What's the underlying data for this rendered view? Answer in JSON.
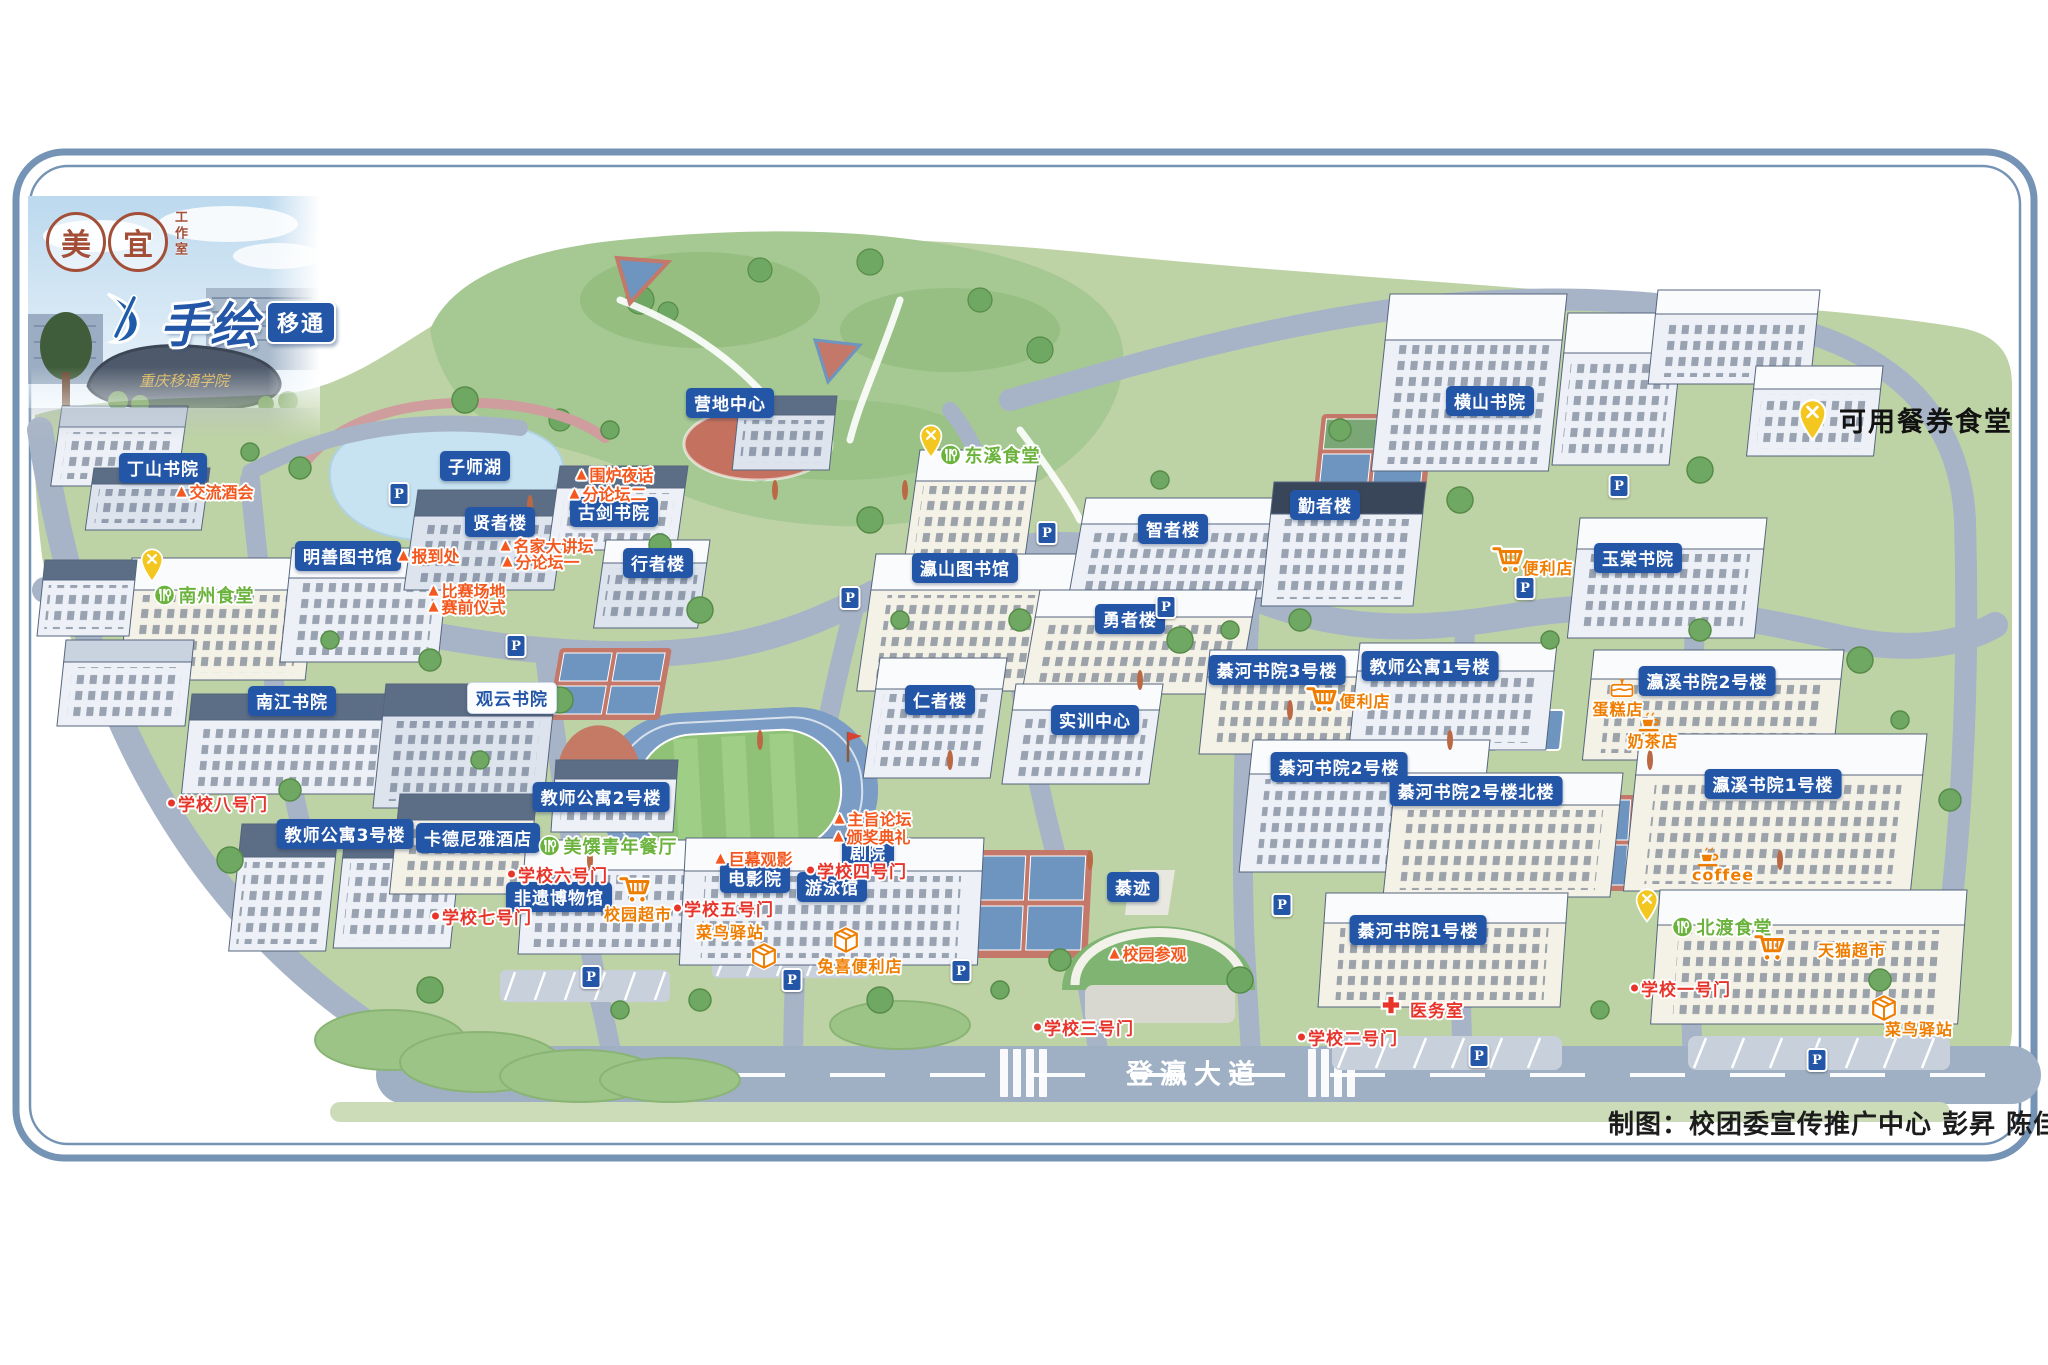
{
  "page": {
    "credits": "制图：校团委宣传推广中心  彭昇 陈佳妮"
  },
  "logo": {
    "seal_left": "美",
    "seal_right": "宜",
    "studio": "工作室",
    "title_main": "手绘",
    "title_sub": "移通",
    "photo_stone_text": "重庆移通学院"
  },
  "legend": {
    "dining_voucher": "可用餐券食堂"
  },
  "road": {
    "name": "登瀛大道"
  },
  "map": {
    "colors": {
      "label-blue": "#2456a8",
      "event-orange": "#f4581e",
      "gate-red": "#e8352b",
      "dining-green": "#6cb33e",
      "shop-orange": "#ef7d00",
      "voucher-yellow": "#f3c71f"
    },
    "parking_letter": "P",
    "blue_labels": [
      {
        "t": "丁山书院",
        "x": 163,
        "y": 468
      },
      {
        "t": "子师湖",
        "x": 475,
        "y": 466
      },
      {
        "t": "贤者楼",
        "x": 500,
        "y": 522
      },
      {
        "t": "古剑书院",
        "x": 614,
        "y": 512
      },
      {
        "t": "明善图书馆",
        "x": 348,
        "y": 556
      },
      {
        "t": "行者楼",
        "x": 658,
        "y": 563
      },
      {
        "t": "南江书院",
        "x": 292,
        "y": 701
      },
      {
        "t": "教师公寓3号楼",
        "x": 345,
        "y": 834
      },
      {
        "t": "卡德尼雅酒店",
        "x": 478,
        "y": 838
      },
      {
        "t": "教师公寓2号楼",
        "x": 601,
        "y": 797
      },
      {
        "t": "营地中心",
        "x": 730,
        "y": 403
      },
      {
        "t": "瀛山图书馆",
        "x": 965,
        "y": 568
      },
      {
        "t": "智者楼",
        "x": 1173,
        "y": 529
      },
      {
        "t": "勇者楼",
        "x": 1130,
        "y": 619
      },
      {
        "t": "仁者楼",
        "x": 940,
        "y": 700
      },
      {
        "t": "实训中心",
        "x": 1095,
        "y": 720
      },
      {
        "t": "勤者楼",
        "x": 1325,
        "y": 505
      },
      {
        "t": "横山书院",
        "x": 1490,
        "y": 401
      },
      {
        "t": "玉棠书院",
        "x": 1638,
        "y": 558
      },
      {
        "t": "綦河书院3号楼",
        "x": 1277,
        "y": 670
      },
      {
        "t": "教师公寓1号楼",
        "x": 1430,
        "y": 666
      },
      {
        "t": "綦河书院2号楼",
        "x": 1339,
        "y": 767
      },
      {
        "t": "綦河书院2号楼北楼",
        "x": 1476,
        "y": 791
      },
      {
        "t": "瀛溪书院2号楼",
        "x": 1707,
        "y": 681
      },
      {
        "t": "瀛溪书院1号楼",
        "x": 1773,
        "y": 784
      },
      {
        "t": "綦河书院1号楼",
        "x": 1418,
        "y": 930
      },
      {
        "t": "綦迹",
        "x": 1133,
        "y": 887
      },
      {
        "t": "剧院",
        "x": 868,
        "y": 852
      },
      {
        "t": "电影院",
        "x": 755,
        "y": 878
      },
      {
        "t": "游泳馆",
        "x": 832,
        "y": 887
      },
      {
        "t": "非遗博物馆",
        "x": 559,
        "y": 897
      }
    ],
    "white_labels": [
      {
        "t": "观云书院",
        "x": 512,
        "y": 698
      }
    ],
    "event_labels": [
      {
        "t": "交流酒会",
        "x": 215,
        "y": 491
      },
      {
        "t": "围炉夜话",
        "x": 615,
        "y": 474
      },
      {
        "t": "分论坛二",
        "x": 608,
        "y": 493
      },
      {
        "t": "报到处",
        "x": 429,
        "y": 555
      },
      {
        "t": "名家大讲坛",
        "x": 547,
        "y": 545
      },
      {
        "t": "分论坛一",
        "x": 541,
        "y": 561
      },
      {
        "t": "比赛场地",
        "x": 467,
        "y": 590
      },
      {
        "t": "赛前仪式",
        "x": 467,
        "y": 606
      },
      {
        "t": "主旨论坛",
        "x": 873,
        "y": 818
      },
      {
        "t": "颁奖典礼",
        "x": 872,
        "y": 836
      },
      {
        "t": "巨幕观影",
        "x": 754,
        "y": 858
      },
      {
        "t": "校园参观",
        "x": 1148,
        "y": 953
      }
    ],
    "gate_labels": [
      {
        "t": "学校八号门",
        "x": 218,
        "y": 803
      },
      {
        "t": "学校七号门",
        "x": 482,
        "y": 916
      },
      {
        "t": "学校六号门",
        "x": 558,
        "y": 874
      },
      {
        "t": "学校五号门",
        "x": 724,
        "y": 908
      },
      {
        "t": "学校四号门",
        "x": 857,
        "y": 870
      },
      {
        "t": "学校三号门",
        "x": 1084,
        "y": 1027
      },
      {
        "t": "学校二号门",
        "x": 1348,
        "y": 1037
      },
      {
        "t": "学校一号门",
        "x": 1681,
        "y": 988
      }
    ],
    "dining_labels": [
      {
        "t": "南州食堂",
        "x": 204,
        "y": 595,
        "pin": {
          "x": 152,
          "y": 565
        }
      },
      {
        "t": "东溪食堂",
        "x": 990,
        "y": 455,
        "pin": {
          "x": 931,
          "y": 441
        }
      },
      {
        "t": "北渡食堂",
        "x": 1722,
        "y": 927,
        "pin": {
          "x": 1647,
          "y": 905
        }
      },
      {
        "t": "美馔青年餐厅",
        "x": 608,
        "y": 846,
        "pin": null
      }
    ],
    "shop_labels": [
      {
        "t": "校园超市",
        "x": 638,
        "y": 913,
        "icon": "cart",
        "ix": 634,
        "iy": 889
      },
      {
        "t": "便利店",
        "x": 1548,
        "y": 567,
        "icon": "cart",
        "ix": 1507,
        "iy": 559
      },
      {
        "t": "便利店",
        "x": 1365,
        "y": 700,
        "icon": "cart",
        "ix": 1321,
        "iy": 699
      },
      {
        "t": "天猫超市",
        "x": 1852,
        "y": 949,
        "icon": "cart",
        "ix": 1769,
        "iy": 947
      },
      {
        "t": "兔喜便利店",
        "x": 860,
        "y": 965,
        "icon": "box",
        "ix": 846,
        "iy": 940
      },
      {
        "t": "菜鸟驿站",
        "x": 730,
        "y": 931,
        "icon": "box",
        "ix": 764,
        "iy": 956
      },
      {
        "t": "菜鸟驿站",
        "x": 1919,
        "y": 1028,
        "icon": "box",
        "ix": 1884,
        "iy": 1008
      },
      {
        "t": "蛋糕店",
        "x": 1618,
        "y": 708,
        "icon": "cake",
        "ix": 1622,
        "iy": 688
      },
      {
        "t": "奶茶店",
        "x": 1653,
        "y": 740,
        "icon": "cup",
        "ix": 1649,
        "iy": 721
      },
      {
        "t": "coffee",
        "x": 1723,
        "y": 875,
        "icon": "cup",
        "ix": 1708,
        "iy": 856
      }
    ],
    "medical_label": {
      "t": "医务室",
      "x": 1437,
      "y": 1009,
      "ix": 1391,
      "iy": 1005
    },
    "parking_icons": [
      [
        399,
        494
      ],
      [
        516,
        646
      ],
      [
        850,
        598
      ],
      [
        1047,
        533
      ],
      [
        1166,
        607
      ],
      [
        1619,
        486
      ],
      [
        1525,
        588
      ],
      [
        1282,
        905
      ],
      [
        1479,
        1056
      ],
      [
        1817,
        1060
      ],
      [
        591,
        977
      ],
      [
        792,
        980
      ],
      [
        961,
        971
      ]
    ]
  }
}
